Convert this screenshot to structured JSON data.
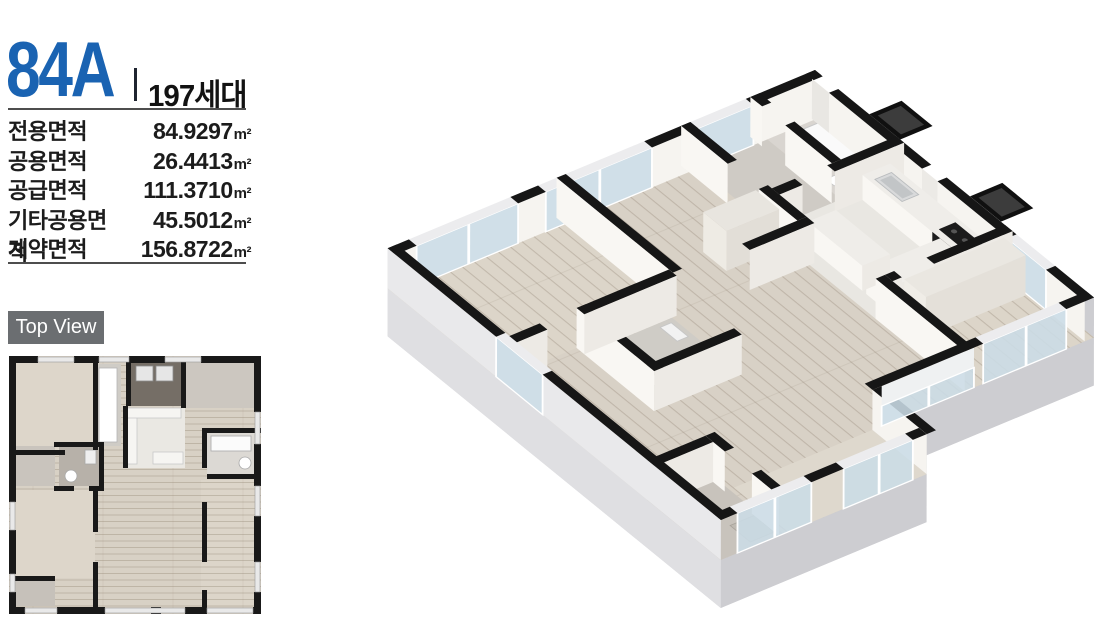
{
  "header": {
    "unit_type": "84A",
    "unit_count": "197세대",
    "accent_color": "#1a63b2"
  },
  "area_table": {
    "rows": [
      {
        "label": "전용면적",
        "value": "84.9297",
        "unit": "m²"
      },
      {
        "label": "공용면적",
        "value": "26.4413",
        "unit": "m²"
      },
      {
        "label": "공급면적",
        "value": "111.3710",
        "unit": "m²"
      },
      {
        "label": "기타공용면적",
        "value": "45.5012",
        "unit": "m²"
      },
      {
        "label": "계약면적",
        "value": "156.8722",
        "unit": "m²"
      }
    ]
  },
  "top_view": {
    "badge_label": "Top View",
    "badge_bg": "#6b6e71"
  },
  "palette": {
    "wall_black": "#161616",
    "wood_floor": "#d8d1c6",
    "plinth_gray": "#d6d6d9",
    "glass_blue": "#cbdce6"
  }
}
